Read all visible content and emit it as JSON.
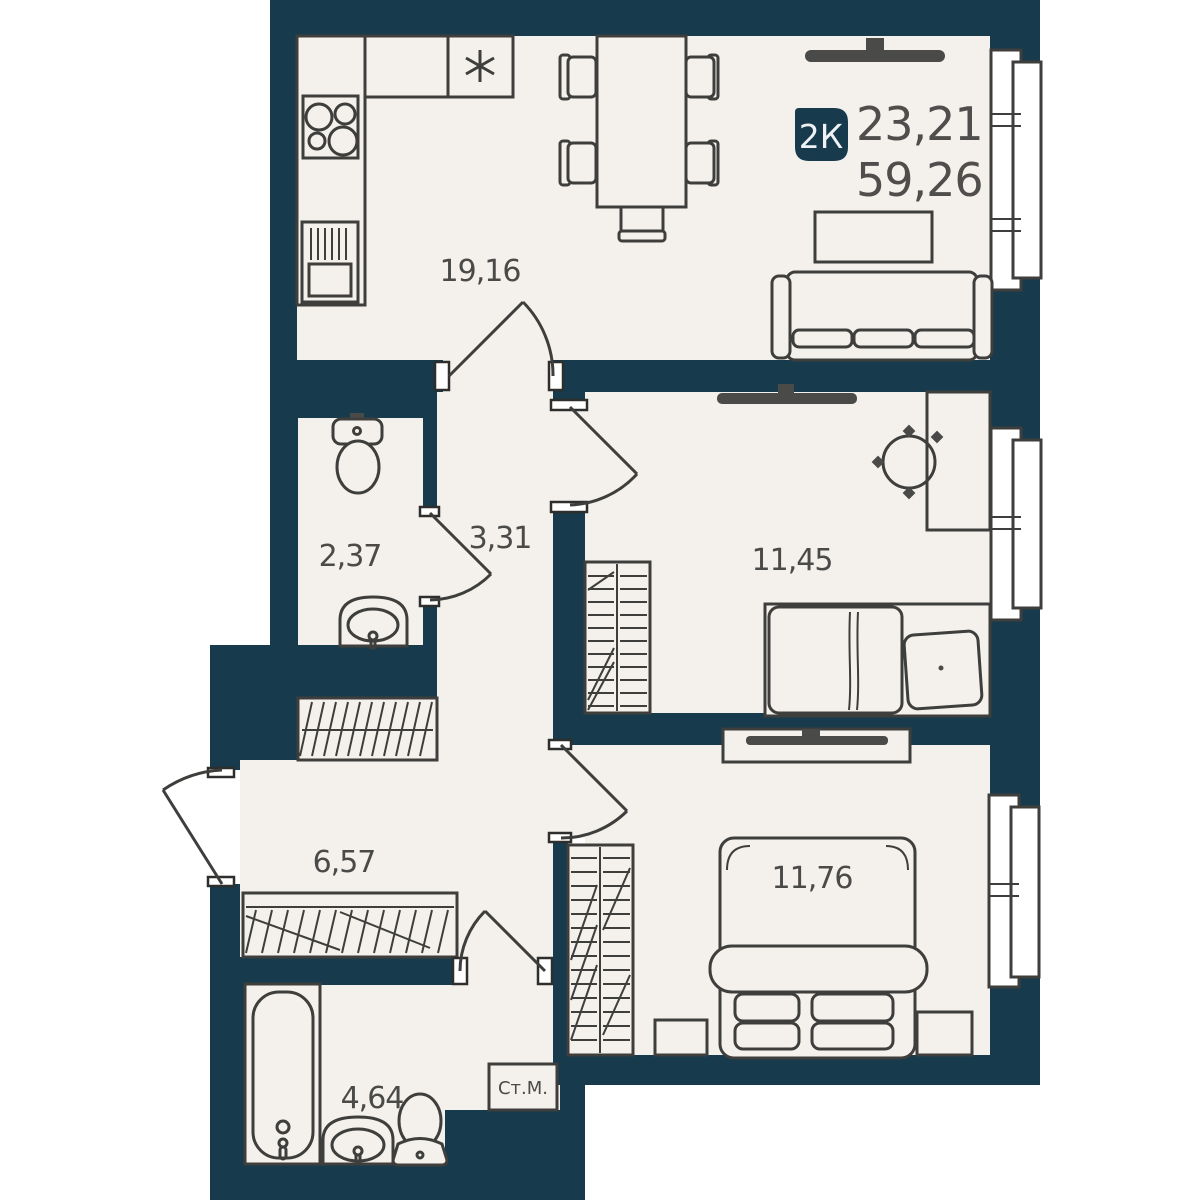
{
  "plan": {
    "badge": {
      "type": "2К",
      "area_living": "23,21",
      "area_total": "59,26"
    },
    "rooms": {
      "kitchen_living": "19,16",
      "hallway": "3,31",
      "toilet": "2,37",
      "bedroom_1": "11,45",
      "corridor": "6,57",
      "bedroom_2": "11,76",
      "bathroom": "4,64"
    },
    "washing_machine": "Ст.М.",
    "colors": {
      "wall": "#173a4d",
      "floor": "#f4f1ec",
      "outside": "#ffffff",
      "furniture_line": "#3e3e3c",
      "text": "#4a4a48",
      "badge_text": "#eef2f4"
    }
  }
}
